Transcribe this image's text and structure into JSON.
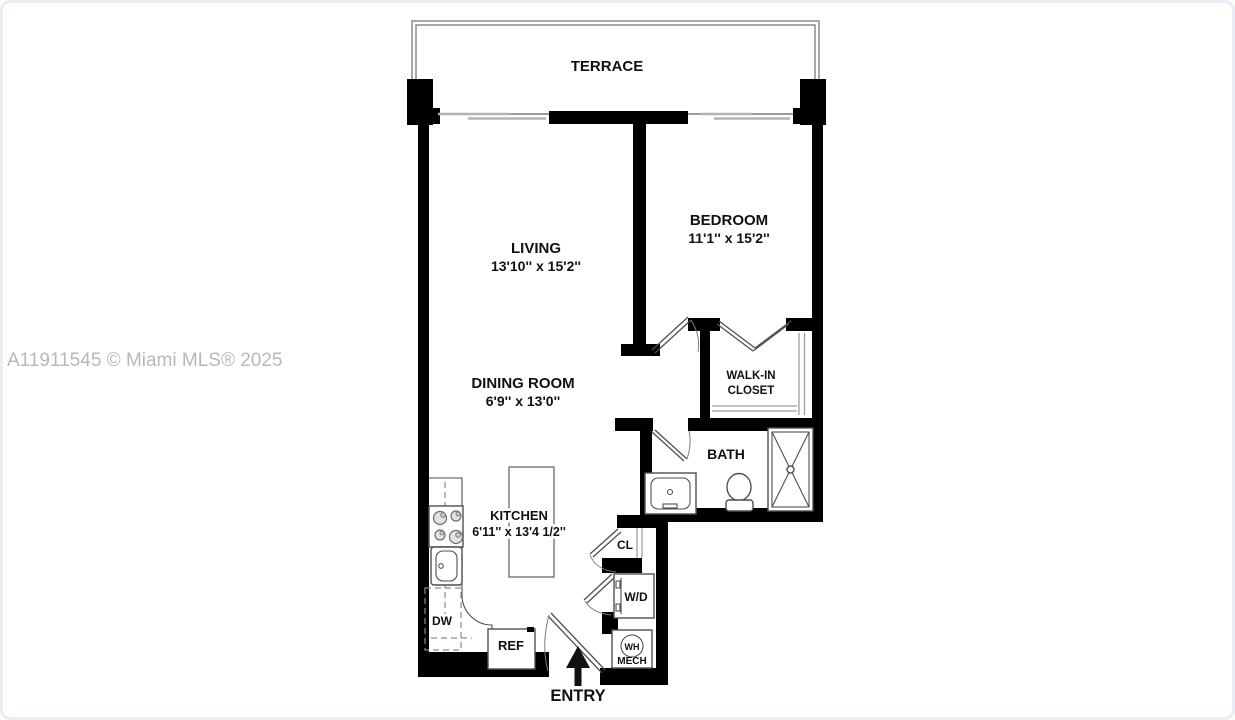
{
  "watermark": "A11911545 © Miami MLS® 2025",
  "rooms": {
    "terrace": {
      "label": "TERRACE"
    },
    "living": {
      "label": "LIVING",
      "dims": "13'10'' x 15'2''"
    },
    "bedroom": {
      "label": "BEDROOM",
      "dims": "11'1'' x 15'2''"
    },
    "dining_room": {
      "label": "DINING ROOM",
      "dims": "6'9'' x 13'0''"
    },
    "kitchen": {
      "label": "KITCHEN",
      "dims": "6'11'' x 13'4 1/2''"
    },
    "walk_in_closet": {
      "line1": "WALK-IN",
      "line2": "CLOSET"
    },
    "bath": {
      "label": "BATH"
    },
    "closet": {
      "label": "CL"
    },
    "entry": {
      "label": "ENTRY"
    }
  },
  "fixtures": {
    "washer_dryer": "W/D",
    "water_heater": "WH",
    "mechanical": "MECH",
    "dishwasher": "DW",
    "refrigerator": "REF"
  },
  "colors": {
    "wall": "#000000",
    "fixture_line": "#4f4f4f",
    "light_line": "#9e9e9e",
    "watermark": "#b8b8b8",
    "background": "#ffffff",
    "text": "#111111"
  }
}
